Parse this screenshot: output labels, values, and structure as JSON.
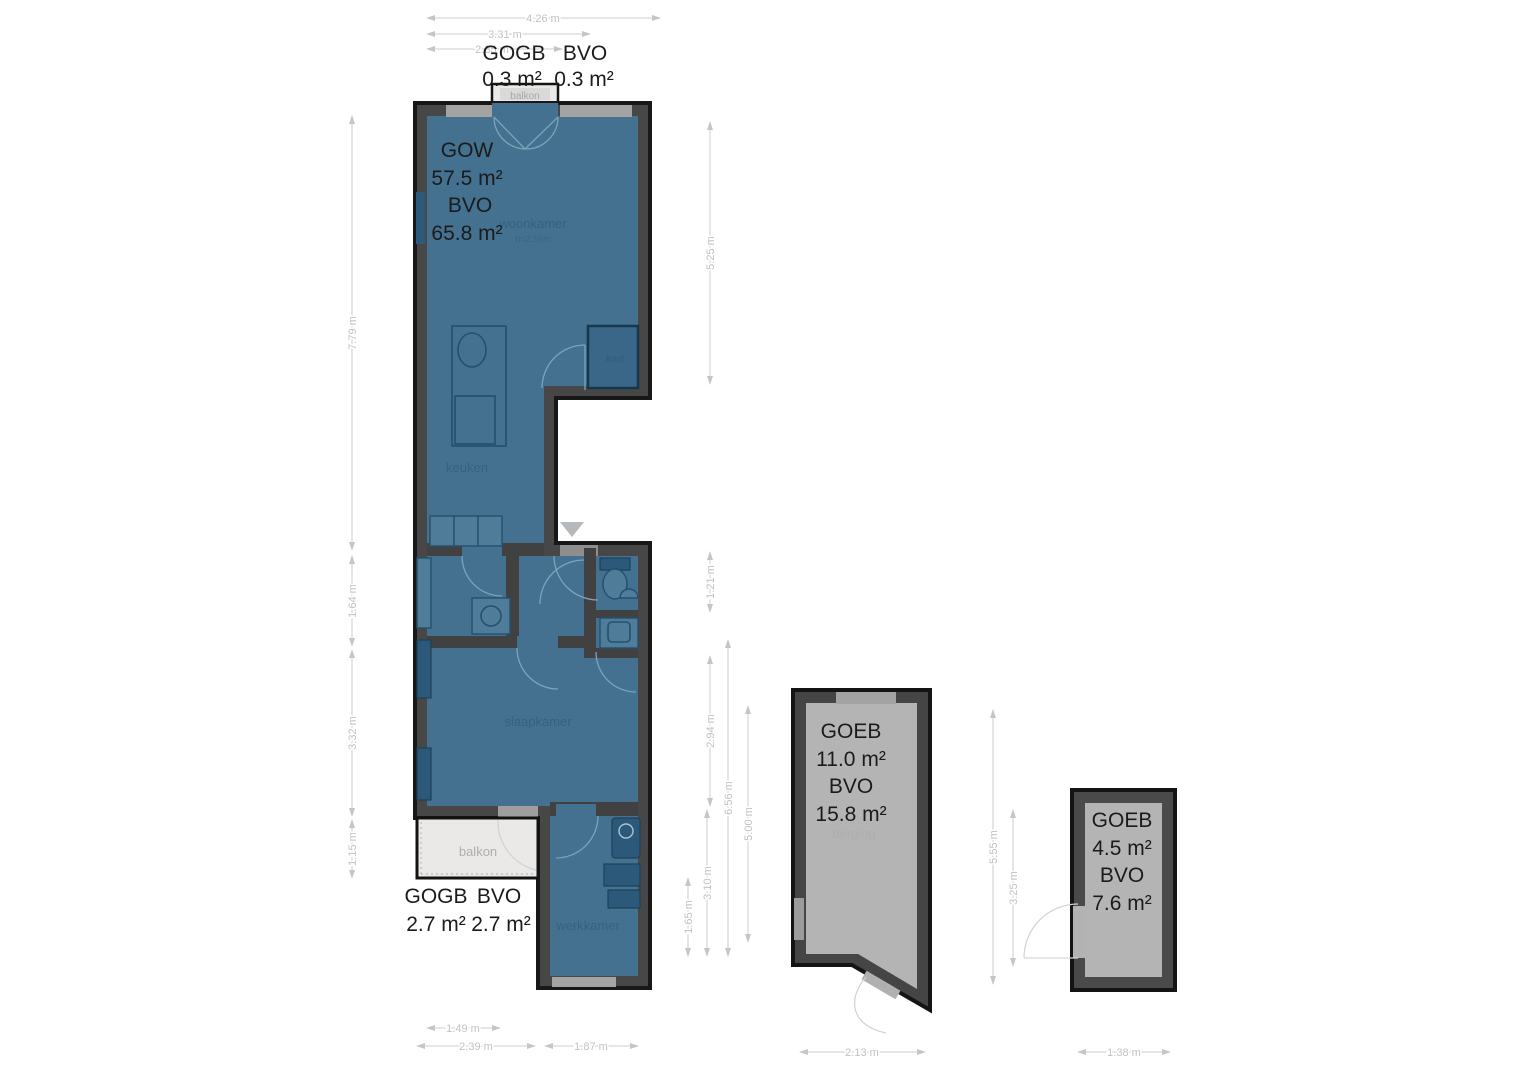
{
  "apartment": {
    "gow_label": "GOW",
    "gow_value": "57.5 m²",
    "bvo_label": "BVO",
    "bvo_value": "65.8 m²",
    "balcony_top_annotation": {
      "gogb_label": "GOGB",
      "bvo_label": "BVO",
      "gogb_value": "0.3 m²",
      "bvo_value": "0.3 m²"
    },
    "balcony_bottom_annotation": {
      "gogb_label": "GOGB",
      "bvo_label": "BVO",
      "gogb_value": "2.7 m²",
      "bvo_value": "2.7 m²"
    },
    "rooms": {
      "balkon_top": "balkon",
      "woonkamer": "woonkamer",
      "woonkamer_height": "h=2.56m",
      "keuken": "keuken",
      "kast": "kast",
      "slaapkamer": "slaapkamer",
      "balkon_bottom": "balkon",
      "werkkamer": "werkkamer"
    },
    "dims": {
      "top_1": "4.26 m",
      "top_2": "3.31 m",
      "top_3": "2.35 m",
      "left_1": "7.79 m",
      "left_2": "1.64 m",
      "left_3": "3.32 m",
      "left_4": "1.15 m",
      "right_1": "5.25 m",
      "right_2": "1.21 m",
      "right_3": "2.94 m",
      "right_4": "6.56 m",
      "right_5": "5.00 m",
      "right_6": "3.10 m",
      "right_7": "1.65 m",
      "bottom_1": "1.49 m",
      "bottom_2": "2.39 m",
      "bottom_3": "1.87 m"
    }
  },
  "storage": {
    "goeb_label": "GOEB",
    "goeb_value": "11.0 m²",
    "bvo_label": "BVO",
    "bvo_value": "15.8 m²",
    "room": "berging",
    "room_height": "h=2.69m",
    "dims": {
      "right_1": "5.55 m",
      "right_2": "3.25 m",
      "bottom": "2.13 m"
    }
  },
  "shed": {
    "goeb_label": "GOEB",
    "goeb_value": "4.5 m²",
    "bvo_label": "BVO",
    "bvo_value": "7.6 m²",
    "dims": {
      "bottom": "1.38 m"
    }
  },
  "colors": {
    "room_fill": "#44718f",
    "room_fill_dark": "#3a6787",
    "wall": "#474747",
    "wall_outline": "#181818",
    "window": "#a3a3a3",
    "balcony_fill": "#eae9e7",
    "storage_fill": "#b4b4b4",
    "dimension": "#c2c2c2",
    "label_dark": "#1b1b1b"
  }
}
